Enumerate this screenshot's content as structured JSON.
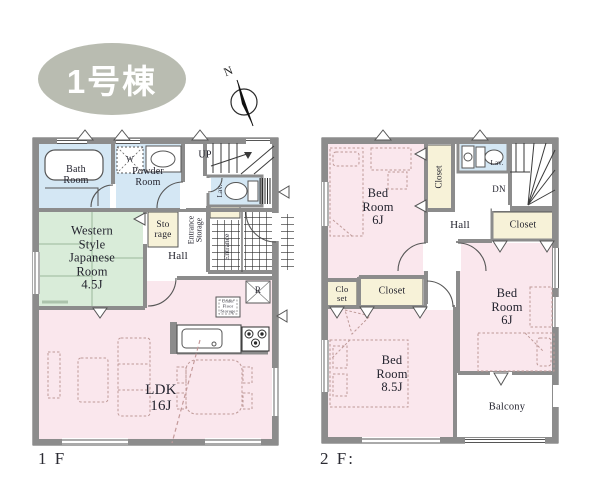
{
  "colors": {
    "wall": "#8c8c8c",
    "wall_edge": "#565656",
    "room_pink": "#fae7ed",
    "room_blue": "#d4e7f4",
    "room_green": "#d9ecd9",
    "room_cream": "#f7f2d8",
    "badge_bg": "#b9bcb1",
    "badge_text": "#ffffff",
    "furniture_dash": "#bf9a98",
    "text": "#23232e"
  },
  "badge": {
    "label": "1号棟"
  },
  "compass": {
    "north": "N"
  },
  "floor1": {
    "caption": "1 F",
    "labels": {
      "bath": "Bath\nRoom",
      "powder": "Powder\nRoom",
      "washer": "W",
      "up": "UP",
      "lav": "Lav.",
      "entrance_storage": "Entrance\nStorage",
      "entrance": "Entrance",
      "storage": "Sto\nrage",
      "japanese": "Western\nStyle\nJapanese\nRoom\n4.5J",
      "hall": "Hall",
      "ldk": "LDK\n16J",
      "underfloor": "Under\nFloor\nStorage",
      "fridge": "R"
    }
  },
  "floor2": {
    "caption": "2 F:",
    "labels": {
      "bed1": "Bed\nRoom\n6J",
      "closet_top": "Closet",
      "lav": "Lav.",
      "dn": "DN",
      "hall": "Hall",
      "closet_right": "Closet",
      "bed2": "Bed\nRoom\n6J",
      "closet_small": "Clo\nset",
      "closet_mid": "Closet",
      "bed3": "Bed\nRoom\n8.5J",
      "balcony": "Balcony"
    }
  }
}
